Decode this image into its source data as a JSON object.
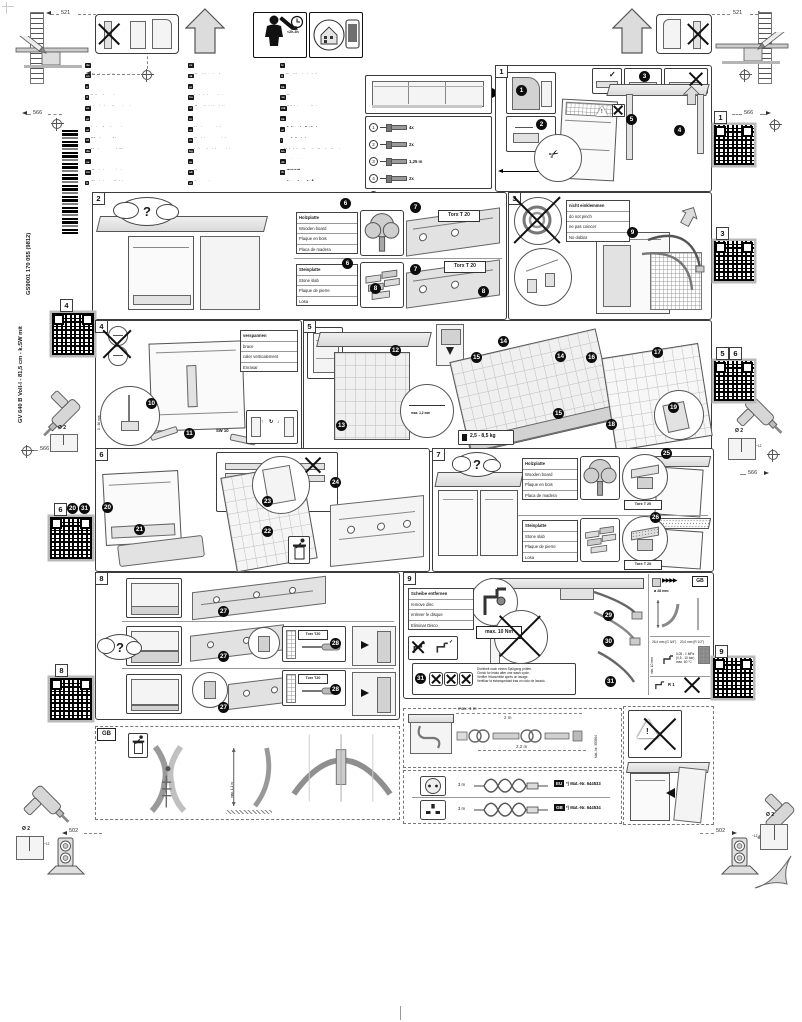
{
  "document": {
    "model_vertical": "GV 640 B Voll-I - 81,5 cm - k.SW mit",
    "code_vertical": "GS9001 170 055 (9812)",
    "duration": "<2h-3h"
  },
  "icons": {
    "question": "?",
    "check": "✓",
    "scissors": "✂",
    "arrow_up": "↑",
    "arrow_cycle": "↻",
    "arrow_down": "↓",
    "warning": "!"
  },
  "dims": {
    "top_left_521": "521",
    "top_right_521": "521",
    "left_top_566": "566",
    "left_mid_566": "566",
    "right_top_566": "566",
    "right_mid_566": "566",
    "bottom_left_502": "502",
    "bottom_right_502": "502"
  },
  "drill_marks": {
    "diameter": "Ø 2",
    "depth": "~12"
  },
  "langs": {
    "col1": [
      {
        "code": "de",
        "l1": "Montageanleitung",
        "l2": "Über Kundendienst erhältlich"
      },
      {
        "code": "en",
        "l1": "Installation instructions",
        "l2": "Available from customer service"
      },
      {
        "code": "fr",
        "l1": "Notice de montage",
        "l2": "Disponible par le biais du service après-vente"
      },
      {
        "code": "it",
        "l1": "Istruzioni per il montaggio",
        "l2": "Disponibili presso il servizio assistenza clienti"
      },
      {
        "code": "es",
        "l1": "Instrucciones de montaje",
        "l2": "Disponible a través del Servicio de Asistencia Técnica"
      },
      {
        "code": "pt",
        "l1": "Instruções de montagem",
        "l2": "Podem ser adquiridas nos Serviços Técnicos"
      },
      {
        "code": "el",
        "l1": "Οδηγίες τοποθέτησης",
        "l2": "Διατίθεται από την υπηρεσία εξυπηρέτησης πελατών"
      },
      {
        "code": "nl",
        "l1": "Montagevoorschrift",
        "l2": "Verkrijgbaar via de servicedienst"
      },
      {
        "code": "da",
        "l1": "Monteringsvejledning",
        "l2": "Fås via kundeservice"
      },
      {
        "code": "sv",
        "l1": "Monteringsanvisning",
        "l2": "Fås hos kundtjänst"
      },
      {
        "code": "no",
        "l1": "Monteringsveiledning",
        "l2": "Kan fås hos kundeservice"
      },
      {
        "code": "fi",
        "l1": "Asennusohje",
        "l2": "Saatavana huoltopalvelusta"
      }
    ],
    "col2": [
      {
        "code": "cs",
        "l1": "Montážní návod",
        "l2": "K dispozici přes zákaznický servis"
      },
      {
        "code": "sk",
        "l1": "Montážny návod",
        "l2": "Dostupné cez zákaznícky servis"
      },
      {
        "code": "pl",
        "l1": "Instrukcja montażu",
        "l2": "Dostępna w punktach serwisowych"
      },
      {
        "code": "hu",
        "l1": "Szerelési útmutató",
        "l2": "A vevőszolgálatnál kapható"
      },
      {
        "code": "sl",
        "l1": "Navodila za montažo",
        "l2": "Na voljo pri servisni službi"
      },
      {
        "code": "hr",
        "l1": "Upute za montažu",
        "l2": "Dostupno preko servisne službe"
      },
      {
        "code": "sr",
        "l1": "Uputstvo za montažu",
        "l2": "Dostupno preko korisničkog servisa"
      },
      {
        "code": "ro",
        "l1": "Instrucţiuni de montaj",
        "l2": "Disponibile la unităţile service"
      },
      {
        "code": "bg",
        "l1": "Указание за монтаж",
        "l2": "Предлага се чрез сервизната служба"
      },
      {
        "code": "ru",
        "l1": "Инструкция по монтажу",
        "l2": "Можно получить через сервисную службу"
      },
      {
        "code": "uk",
        "l1": "Інструкція з монтажу",
        "l2": "Можна отримати через сервісну службу"
      },
      {
        "code": "et",
        "l1": "Paigaldusjuhend",
        "l2": "Saadaval klienditeeninduse kaudu"
      }
    ],
    "col3": [
      {
        "code": "lv",
        "l1": "Montāžas instrukcija",
        "l2": "Pieejama klientu servisā"
      },
      {
        "code": "lt",
        "l1": "Montavimo instrukcija",
        "l2": "Galima gauti iš klientų aptarnavimo tarnybos"
      },
      {
        "code": "kk",
        "l1": "Монтаждау нұсқаулығы",
        "l2": "Сервистік қызмет арқылы алуға болады"
      },
      {
        "code": "sq",
        "l1": "Udhëzime montimi",
        "l2": "I disponueshëm përmes shërbimit të klientëve"
      },
      {
        "code": "mk",
        "l1": "Упатство за монтажа",
        "l2": "Достапно преку сервисната служба"
      },
      {
        "code": "ka",
        "l1": "მონტაჟის ინსტრუქცია",
        "l2": "ხელმისაწვდომია სერვისცენტრში"
      },
      {
        "code": "ar",
        "l1": "تعليمات التركيب",
        "l2": "متوفرة لدى خدمة العملاء"
      },
      {
        "code": "i",
        "l1": "Mehr Infos über den Kundendienst",
        "l2": "More details via Customer Service"
      },
      {
        "code": "ko",
        "l1": "설치 설명서",
        "l2": "고객 서비스 센터에서 제공"
      },
      {
        "code": "zh",
        "l1": "安装说明",
        "l2": "可通过客户服务部获取"
      },
      {
        "code": "th",
        "l1": "คำแนะนำการติดตั้ง",
        "l2": "มีให้บริการผ่านศูนย์บริการ"
      }
    ]
  },
  "parts": {
    "rows": [
      {
        "n": "1",
        "q": "4x"
      },
      {
        "n": "2",
        "q": "2x"
      },
      {
        "n": "3",
        "q": "1,25 m"
      },
      {
        "n": "4",
        "q": "2x"
      },
      {
        "n": "5",
        "q": "4x"
      },
      {
        "n": "6",
        "q": "2x"
      },
      {
        "n": "7",
        "q": "2x"
      },
      {
        "n": "8",
        "q": "1x"
      }
    ]
  },
  "wood_label": [
    "Holzplatte",
    "Wooden board",
    "Plaque en bois",
    "Placa de madera"
  ],
  "stone_label": [
    "Steinplatte",
    "Stone slab",
    "Plaque de pierre",
    "Losa"
  ],
  "steps": {
    "s1": {
      "label": "1",
      "badges": [
        "1",
        "2",
        "3",
        "4",
        "5"
      ]
    },
    "s2": {
      "label": "2",
      "torx": "Torx T 20",
      "badges": [
        "6",
        "7",
        "6",
        "7",
        "8",
        "8"
      ]
    },
    "s3": {
      "label": "3",
      "pinch": [
        "nicht einklemmen",
        "do not pinch",
        "ne pas coincer",
        "No doblar"
      ],
      "badges": [
        "9"
      ]
    },
    "s4": {
      "label": "4",
      "brace": [
        "verspannen",
        "brace",
        "caler verticalement",
        "Enrasar"
      ],
      "range": "0 - 60 mm",
      "sw13": "SW 13",
      "sw10": "SW 10",
      "badges": [
        "10",
        "11"
      ]
    },
    "s5": {
      "label": "5",
      "gap": "max. 1,2 mm",
      "weight": "2,5 - 8,5 kg",
      "badges": [
        "12",
        "13",
        "14",
        "15",
        "14",
        "15",
        "16",
        "17",
        "18",
        "19"
      ]
    },
    "s6": {
      "label": "6",
      "badges": [
        "20",
        "21",
        "22",
        "23",
        "24"
      ]
    },
    "s7": {
      "label": "7",
      "torx": "Torx T 20",
      "badges": [
        "25",
        "26"
      ]
    },
    "s8": {
      "label": "8",
      "torx": "Torx T20",
      "badges": [
        "27",
        "27",
        "27",
        "28",
        "28"
      ]
    },
    "s9": {
      "label": "9",
      "disc": [
        "Scheibe entfernen",
        "remove disc",
        "enlever le disque",
        "Eliminar Disco"
      ],
      "torque": "max. 10 Nm",
      "check": [
        "Dichtheit nach einem Spülgang prüfen.",
        "Check for leaks after one wash cycle.",
        "Vérifier l'étanchéité après un lavage.",
        "Verificar la estanqueidad tras un ciclo de lavado."
      ],
      "badges": [
        "29",
        "30",
        "31",
        "31"
      ],
      "specs": {
        "gb": "GB",
        "hose_d": "ø 28 mm",
        "conn1": "26,4 mm (G 3/4\")",
        "conn2": "20,0 mm (R 1/2\")",
        "min_gap": "min. 10 mm",
        "pressure": "0,05 - 1 MPa",
        "pressure_bar": "(0,5 - 10 bar)",
        "temp": "max. 60 °C",
        "thread": "R 1"
      }
    }
  },
  "qr": {
    "right_1": "1",
    "right_3": "3",
    "right_5": "5",
    "right_6": "6",
    "right_9": "9",
    "left_4": "4",
    "left_6": "6",
    "left_6_badges": [
      "20",
      "31"
    ],
    "left_8": "8"
  },
  "gb_section": {
    "label": "GB",
    "dim": "max. 1,1 m"
  },
  "hose_ext": {
    "dim_a": "max. 1 m",
    "dim_b": "2 m",
    "dim_c": "2,2 m",
    "mat": "Mat.-Nr. 350564"
  },
  "plugs": {
    "rows": [
      {
        "len": "3 m",
        "region": "EU",
        "mat": "*) Mat.-Nr. 644533"
      },
      {
        "len": "3 m",
        "region": "GB",
        "mat": "*) Mat.-Nr. 644534"
      }
    ]
  }
}
